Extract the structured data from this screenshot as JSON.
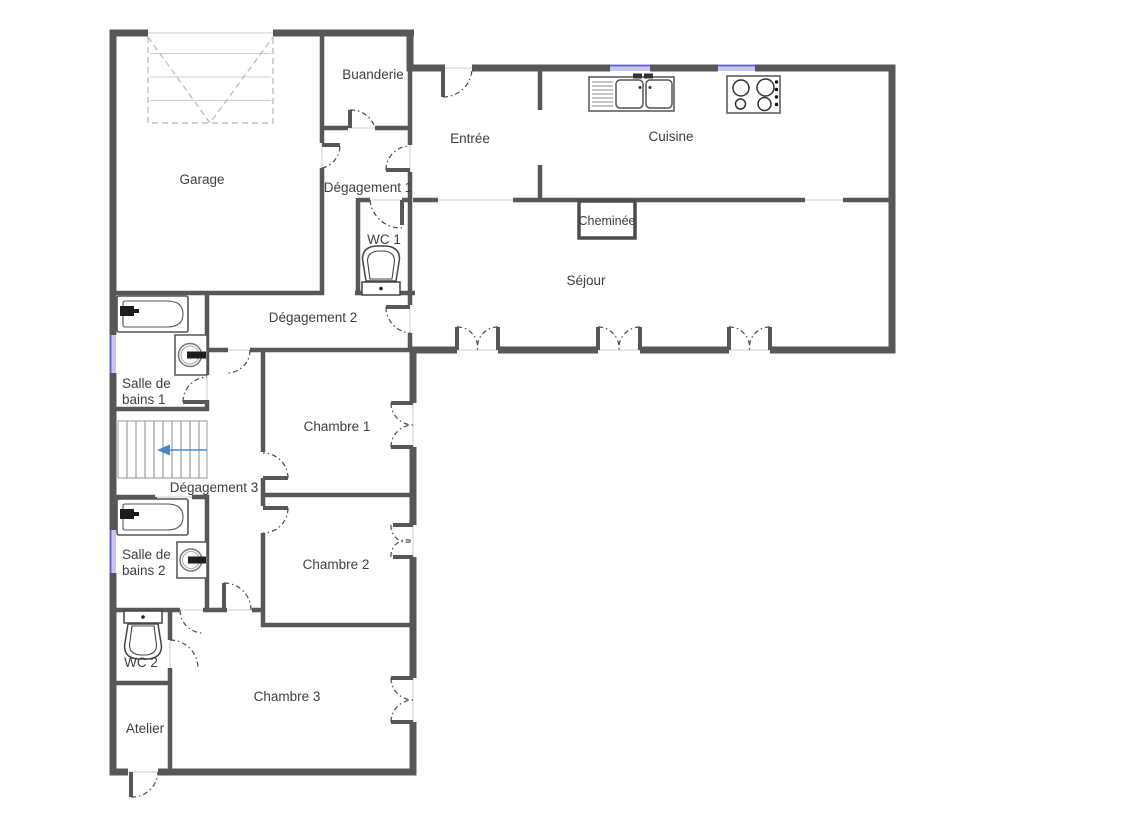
{
  "title": "Plan de maison",
  "colors": {
    "background": "#ffffff",
    "wall": "#575757",
    "opening_line": "#dedede",
    "window_fill": "#c7c7ed",
    "window_accent": "#5d5dd0",
    "door_arc": "#4a4a4a",
    "garage_door_dash": "#b8b8b8",
    "stairs_arrow": "#4a86c8",
    "text": "#3f3f3f"
  },
  "rooms": {
    "garage": {
      "label": "Garage"
    },
    "buanderie": {
      "label": "Buanderie"
    },
    "degagement1": {
      "label": "Dégagement 1"
    },
    "wc1": {
      "label": "WC 1"
    },
    "entree": {
      "label": "Entrée"
    },
    "cuisine": {
      "label": "Cuisine"
    },
    "cheminee": {
      "label": "Cheminée"
    },
    "sejour": {
      "label": "Séjour"
    },
    "degagement2": {
      "label": "Dégagement 2"
    },
    "salle_de_bains_1": {
      "label": "Salle de\nbains 1"
    },
    "degagement3": {
      "label": "Dégagement 3"
    },
    "chambre1": {
      "label": "Chambre 1"
    },
    "salle_de_bains_2": {
      "label": "Salle de\nbains 2"
    },
    "chambre2": {
      "label": "Chambre 2"
    },
    "wc2": {
      "label": "WC 2"
    },
    "chambre3": {
      "label": "Chambre 3"
    },
    "atelier": {
      "label": "Atelier"
    }
  },
  "fixtures": {
    "garage_door": "garage-door",
    "stairs": "staircase",
    "stairs_direction": "arrow-left",
    "bathtub_1": "bathtub",
    "bathtub_2": "bathtub",
    "washing_machine_1": "washing-machine",
    "washing_machine_2": "washing-machine",
    "toilet_1": "toilet",
    "toilet_2": "toilet",
    "kitchen_sink": "double-sink",
    "stove": "cooktop-4-burners",
    "fireplace": "fireplace",
    "windows": "window-marker",
    "doors": "door-swing"
  }
}
